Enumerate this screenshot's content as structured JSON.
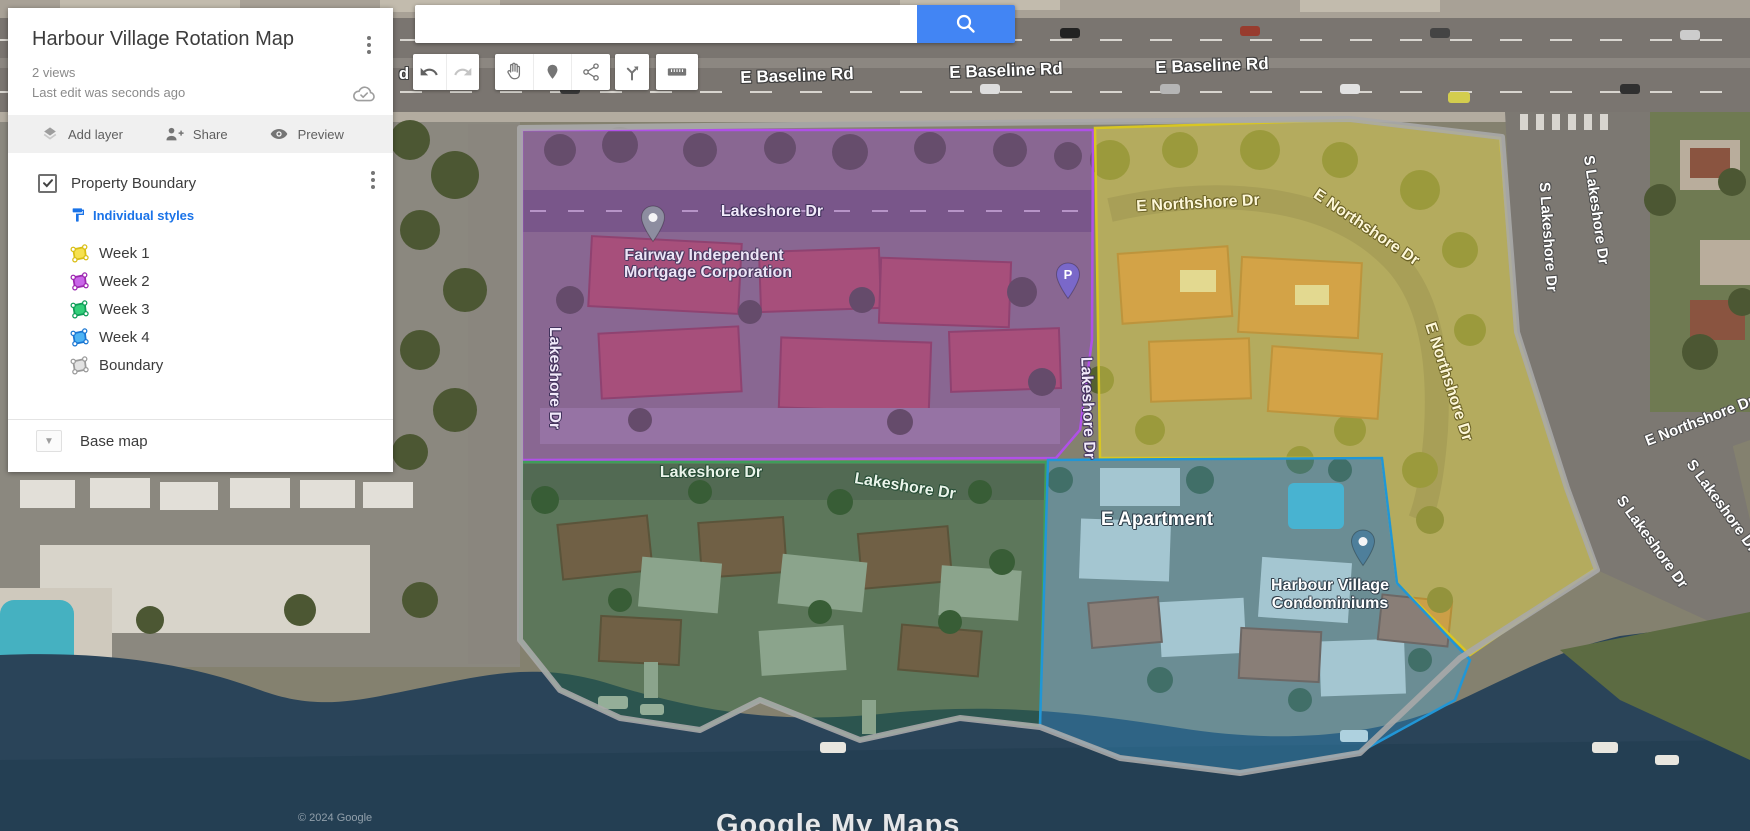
{
  "panel": {
    "title": "Harbour Village Rotation Map",
    "views": "2 views",
    "last_edit": "Last edit was seconds ago",
    "actions": [
      {
        "label": "Add layer",
        "icon": "layers-icon"
      },
      {
        "label": "Share",
        "icon": "person-add-icon"
      },
      {
        "label": "Preview",
        "icon": "eye-icon"
      }
    ],
    "layer": {
      "name": "Property Boundary",
      "checked": true,
      "styles_link": "Individual styles",
      "items": [
        {
          "label": "Week 1",
          "fill": "#F6E14E",
          "stroke": "#D9BE14"
        },
        {
          "label": "Week 2",
          "fill": "#C965E8",
          "stroke": "#9C27B0"
        },
        {
          "label": "Week 3",
          "fill": "#33CF7A",
          "stroke": "#0F9D58"
        },
        {
          "label": "Week 4",
          "fill": "#4DB3F4",
          "stroke": "#1976D2"
        },
        {
          "label": "Boundary",
          "fill": "#E2E2E2",
          "stroke": "#9A9A9A"
        }
      ]
    },
    "base_map_label": "Base map"
  },
  "search": {
    "value": "",
    "button_icon": "search-icon",
    "accent": "#4285f4"
  },
  "toolbar": {
    "buttons": [
      "undo",
      "redo",
      "pan-hand",
      "add-marker",
      "draw-line",
      "add-directions",
      "measure-ruler"
    ]
  },
  "map": {
    "attribution": "© 2024 Google",
    "watermark": "Google My Maps",
    "regions": [
      {
        "name": "Week 1",
        "fill": "#e9d94b",
        "stroke": "#d8c622"
      },
      {
        "name": "Week 2",
        "fill": "#9040c8",
        "stroke": "#b050e8"
      },
      {
        "name": "Week 3",
        "fill": "#2f6b43",
        "stroke": "#3f9d5a"
      },
      {
        "name": "Week 4",
        "fill": "#39a7e0",
        "stroke": "#2196d6"
      },
      {
        "name": "Boundary",
        "fill": "none",
        "stroke": "#a8a8a8"
      }
    ],
    "labels": [
      {
        "text": "d",
        "x": 404,
        "y": 74,
        "rot": 0,
        "kind": "baseline"
      },
      {
        "text": "E Baseline Rd",
        "x": 797,
        "y": 76,
        "rot": -2,
        "kind": "baseline"
      },
      {
        "text": "E Baseline Rd",
        "x": 1006,
        "y": 71,
        "rot": -2,
        "kind": "baseline"
      },
      {
        "text": "E Baseline Rd",
        "x": 1212,
        "y": 66,
        "rot": -2,
        "kind": "baseline"
      },
      {
        "text": "Lakeshore Dr",
        "x": 772,
        "y": 212,
        "rot": 0,
        "kind": "purple-road"
      },
      {
        "text": "Lakeshore Dr",
        "x": 554,
        "y": 378,
        "rot": 90,
        "kind": "purple-road"
      },
      {
        "text": "Lakeshore Dr",
        "x": 1087,
        "y": 408,
        "rot": 88,
        "kind": "purple-road"
      },
      {
        "text": "Fairway Independent",
        "x": 704,
        "y": 256,
        "rot": 0,
        "kind": "purple-poi"
      },
      {
        "text": "Mortgage Corporation",
        "x": 708,
        "y": 273,
        "rot": 0,
        "kind": "purple-poi"
      },
      {
        "text": "E Northshore Dr",
        "x": 1198,
        "y": 204,
        "rot": -3,
        "kind": "yellow-road"
      },
      {
        "text": "E Northshore Dr",
        "x": 1366,
        "y": 228,
        "rot": 34,
        "kind": "yellow-road"
      },
      {
        "text": "E Northshore Dr",
        "x": 1448,
        "y": 382,
        "rot": 72,
        "kind": "yellow-road"
      },
      {
        "text": "E Northshore Dr",
        "x": 1700,
        "y": 421,
        "rot": -21,
        "kind": "gray-road"
      },
      {
        "text": "S Lakeshore Dr",
        "x": 1548,
        "y": 237,
        "rot": 86,
        "kind": "gray-road"
      },
      {
        "text": "S Lakeshore Dr",
        "x": 1596,
        "y": 210,
        "rot": 82,
        "kind": "gray-road"
      },
      {
        "text": "S Lakeshore Dr",
        "x": 1652,
        "y": 542,
        "rot": 54,
        "kind": "gray-road"
      },
      {
        "text": "S Lakeshore Dr",
        "x": 1722,
        "y": 506,
        "rot": 54,
        "kind": "gray-road"
      },
      {
        "text": "Lakeshore Dr",
        "x": 711,
        "y": 473,
        "rot": 0,
        "kind": "green-road"
      },
      {
        "text": "Lakeshore Dr",
        "x": 905,
        "y": 487,
        "rot": 9,
        "kind": "green-road"
      },
      {
        "text": "E Apartment",
        "x": 1157,
        "y": 520,
        "rot": 0,
        "kind": "white-poi-lg"
      },
      {
        "text": "Harbour Village",
        "x": 1330,
        "y": 586,
        "rot": 0,
        "kind": "white-poi"
      },
      {
        "text": "Condominiums",
        "x": 1330,
        "y": 604,
        "rot": 0,
        "kind": "white-poi"
      }
    ],
    "pins": [
      {
        "name": "location-pin-gray",
        "x": 653,
        "y": 243,
        "color": "#8d8da0",
        "hole": true
      },
      {
        "name": "parking-pin",
        "x": 1068,
        "y": 300,
        "color": "#7a68c9",
        "letter": "P"
      },
      {
        "name": "location-pin-blue",
        "x": 1363,
        "y": 567,
        "color": "#4e7f9b",
        "hole": true
      }
    ]
  }
}
